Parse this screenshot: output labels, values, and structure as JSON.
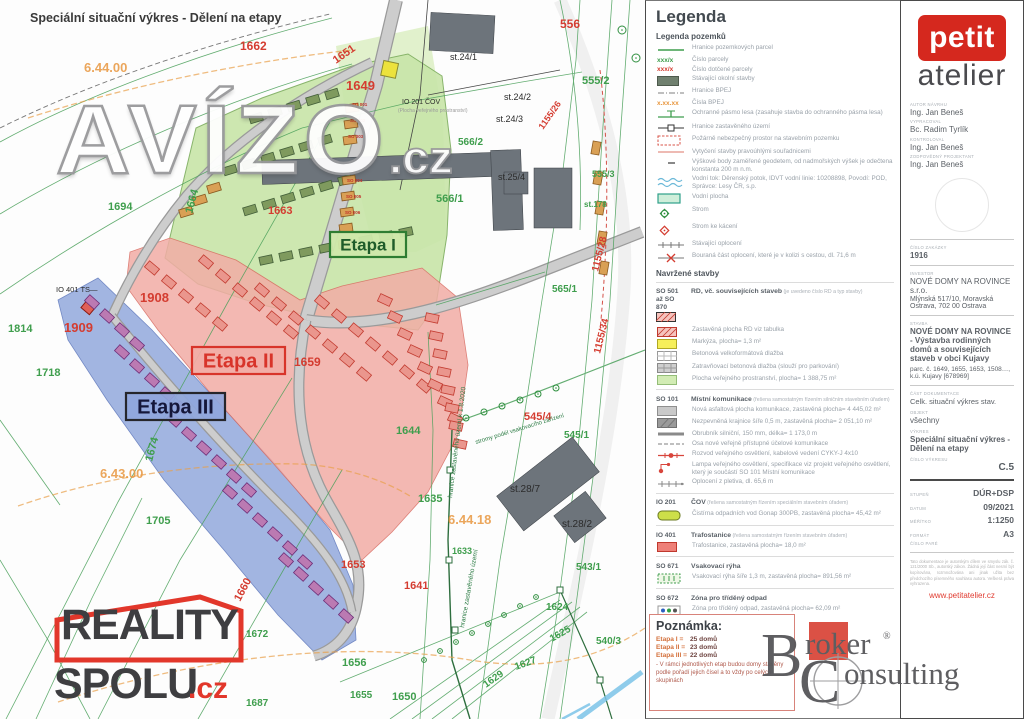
{
  "map": {
    "title": "Speciální situační výkres - Dělení na etapy",
    "etapas": [
      {
        "label": "Etapa I",
        "x": 330,
        "y": 232,
        "w": 76,
        "h": 25,
        "fill": "rgba(205,232,170,0.95)",
        "stroke": "#2e7d32",
        "color": "#1f5c2a",
        "size": 17
      },
      {
        "label": "Etapa II",
        "x": 192,
        "y": 347,
        "w": 93,
        "h": 27,
        "fill": "rgba(242,173,166,0.92)",
        "stroke": "#d8342a",
        "color": "#d8342a",
        "size": 20
      },
      {
        "label": "Etapa III",
        "x": 126,
        "y": 393,
        "w": 99,
        "h": 27,
        "fill": "rgba(143,166,220,0.92)",
        "stroke": "#26262b",
        "color": "#15173a",
        "size": 20
      }
    ],
    "labels": [
      [
        "Speciální situační výkres - Dělení na etapy",
        30,
        22,
        "t",
        12.5,
        0
      ],
      [
        "1694",
        108,
        210,
        "g",
        11,
        0
      ],
      [
        "1664",
        192,
        214,
        "g",
        11,
        -75
      ],
      [
        "1814",
        8,
        332,
        "g",
        11,
        0
      ],
      [
        "1718",
        36,
        376,
        "g",
        11,
        0
      ],
      [
        "1705",
        146,
        524,
        "g",
        11,
        0
      ],
      [
        "1644",
        396,
        434,
        "g",
        11,
        0
      ],
      [
        "1635",
        418,
        502,
        "g",
        11,
        0
      ],
      [
        "1633",
        452,
        554,
        "g",
        9,
        0
      ],
      [
        "1656",
        342,
        666,
        "g",
        11,
        0
      ],
      [
        "1655",
        350,
        698,
        "g",
        10,
        0
      ],
      [
        "1650",
        392,
        700,
        "g",
        11,
        0
      ],
      [
        "1672",
        246,
        637,
        "g",
        10,
        0
      ],
      [
        "1687",
        246,
        706,
        "g",
        10,
        0
      ],
      [
        "1629",
        486,
        688,
        "g",
        10,
        -35
      ],
      [
        "1627",
        516,
        670,
        "g",
        10,
        -20
      ],
      [
        "1624",
        546,
        610,
        "g",
        10,
        0
      ],
      [
        "1625",
        552,
        642,
        "g",
        10,
        -30
      ],
      [
        "565/1",
        552,
        292,
        "g",
        10,
        0
      ],
      [
        "566/1",
        436,
        202,
        "g",
        11,
        0
      ],
      [
        "566/2",
        458,
        145,
        "g",
        10,
        0
      ],
      [
        "555/2",
        582,
        84,
        "g",
        11,
        0
      ],
      [
        "555/3",
        592,
        177,
        "g",
        9,
        0
      ],
      [
        "545/1",
        564,
        438,
        "g",
        10,
        0
      ],
      [
        "543/1",
        576,
        570,
        "g",
        10,
        0
      ],
      [
        "540/3",
        596,
        644,
        "g",
        10,
        0
      ],
      [
        "st.178",
        584,
        207,
        "g",
        8,
        0
      ],
      [
        "1674",
        152,
        462,
        "g",
        11,
        -75
      ],
      [
        "1662",
        240,
        50,
        "r",
        12,
        0
      ],
      [
        "1649",
        346,
        90,
        "r",
        13,
        0
      ],
      [
        "1651",
        336,
        64,
        "r",
        11,
        -35
      ],
      [
        "1663",
        268,
        214,
        "r",
        11,
        0
      ],
      [
        "1908",
        140,
        302,
        "r",
        13,
        0
      ],
      [
        "1909",
        64,
        332,
        "r",
        13,
        0
      ],
      [
        "1659",
        294,
        366,
        "r",
        12,
        0
      ],
      [
        "556",
        560,
        28,
        "r",
        12,
        0
      ],
      [
        "545/4",
        524,
        420,
        "r",
        11,
        0
      ],
      [
        "1641",
        404,
        589,
        "r",
        11,
        0
      ],
      [
        "1653",
        341,
        568,
        "r",
        11,
        0
      ],
      [
        "1660",
        240,
        602,
        "r",
        11,
        -62
      ],
      [
        "1155/28",
        598,
        272,
        "r",
        10,
        -76
      ],
      [
        "1155/34",
        600,
        354,
        "r",
        10,
        -76
      ],
      [
        "1155/26",
        543,
        130,
        "r",
        9,
        -55
      ],
      [
        "6.44.00",
        84,
        72,
        "o",
        13,
        0
      ],
      [
        "6.43.00",
        100,
        478,
        "o",
        13,
        0
      ],
      [
        "6.44.18",
        448,
        524,
        "o",
        13,
        0
      ],
      [
        "st.24/1",
        450,
        60,
        "k",
        9,
        0
      ],
      [
        "st.24/2",
        504,
        100,
        "k",
        9,
        0
      ],
      [
        "st.24/3",
        496,
        122,
        "k",
        9,
        0
      ],
      [
        "st.25/4",
        498,
        180,
        "k",
        9,
        0
      ],
      [
        "st.28/7",
        510,
        492,
        "k",
        10,
        0
      ],
      [
        "st.28/2",
        562,
        527,
        "k",
        10,
        0
      ],
      [
        "IO 401 TS—",
        56,
        292,
        "k",
        7.5,
        0
      ],
      [
        "IO 201 ČOV",
        402,
        104,
        "k",
        7,
        0
      ],
      [
        "(Plocha veřejného prostranství)",
        398,
        112,
        "gy",
        5,
        0
      ],
      [
        "hranice zastavěného území k 1.8.2020",
        452,
        498,
        "dg",
        6.5,
        -83
      ],
      [
        "hranice zastavěného území",
        464,
        628,
        "dg",
        6.5,
        -80
      ],
      [
        "stromy podél vsakovacího zařízení",
        476,
        444,
        "dg",
        6,
        -17
      ],
      [
        "SO 001",
        352,
        106,
        "rs",
        4.5,
        0
      ],
      [
        "SO 002",
        350,
        122,
        "rs",
        4.5,
        0
      ],
      [
        "SO 003",
        348,
        138,
        "rs",
        4.5,
        0
      ],
      [
        "SO 004",
        347,
        182,
        "rs",
        4.5,
        0
      ],
      [
        "SO 005",
        346,
        198,
        "rs",
        4.5,
        0
      ],
      [
        "SO 006",
        345,
        214,
        "rs",
        4.5,
        0
      ]
    ]
  },
  "legend": {
    "title": "Legenda",
    "subtitle": "Legenda pozemků",
    "groups": [
      {
        "type": "plain",
        "rows": [
          {
            "sym": "line-green",
            "text": "Hranice pozemkových parcel"
          },
          {
            "sym": "num-green",
            "text": "Číslo parcely"
          },
          {
            "sym": "num-red",
            "text": "Číslo dotčené parcely"
          },
          {
            "sym": "rect-dkgreen",
            "text": "Stávající okolní stavby"
          },
          {
            "sym": "line-dashdot",
            "text": "Hranice BPEJ"
          },
          {
            "sym": "num-orange",
            "text": "Čísla BPEJ"
          },
          {
            "sym": "line-T",
            "text": "Ochranné pásmo lesa (zasahuje stavba do ochranného pásma lesa)"
          },
          {
            "sym": "line-sq",
            "text": "Hranice zastavěného území"
          },
          {
            "sym": "rect-reddash",
            "text": "Požárně nebezpečný prostor na stavebním pozemku"
          },
          {
            "sym": "line-pink",
            "text": "Vytyčení stavby pravoúhlými souřadnicemi"
          },
          {
            "sym": "tick",
            "text": "Výškové body zaměřené geodetem, od nadmořských výšek je odečtena konstanta 200 m n.m."
          },
          {
            "sym": "wavy",
            "text": "Vodní tok: Děrenský potok, IDVT vodní linie: 10208898, Povodí: POD, Správce: Lesy ČR, s.p."
          },
          {
            "sym": "rect-teal",
            "text": "Vodní plocha"
          },
          {
            "sym": "tree",
            "text": "Strom"
          },
          {
            "sym": "tree-red",
            "text": "Strom ke kácení"
          },
          {
            "sym": "fence",
            "text": "Stávající oplocení"
          },
          {
            "sym": "fence-x",
            "text": "Bouraná část oplocení, které je v kolizi s cestou, dl. 71,6 m"
          }
        ]
      },
      {
        "type": "heading",
        "text": "Navržené stavby"
      },
      {
        "type": "block",
        "code": "SO 501 až SO 870",
        "codeSym": "hatch-red-b",
        "title": "RD, vč. souvisejících staveb",
        "note": "(je uvedeno číslo RD a typ stavby)",
        "rows": [
          {
            "sym": "hatch-red",
            "text": "Zastavěná plocha RD viz tabulka"
          },
          {
            "sym": "rect-yellow",
            "text": "Markýza, plocha= 1,3 m²"
          },
          {
            "sym": "grid-white",
            "text": "Betonová velkoformátová dlažba"
          },
          {
            "sym": "grid-gray",
            "text": "Zatravňovací betonová dlažba (slouží pro parkování)"
          },
          {
            "sym": "rect-lgreen",
            "text": "Plocha veřejného prostranství, plocha= 1 388,75 m²"
          }
        ]
      },
      {
        "type": "block",
        "code": "SO 101",
        "title": "Místní komunikace",
        "note": "(řešena samostatným řízením silničním stavebním úřadem)",
        "rows": [
          {
            "sym": "rect-gray",
            "text": "Nová asfaltová plocha komunikace, zastavěná plocha= 4 445,02 m²"
          },
          {
            "sym": "rect-dgray",
            "text": "Nezpevněná krajnice šíře 0,5 m, zastavěná plocha= 2 051,10 m²"
          },
          {
            "sym": "line-thick",
            "text": "Obrubník silniční, 150 mm, délka= 1 173,0 m"
          },
          {
            "sym": "line-dash",
            "text": "Osa nové veřejně přístupné účelové komunikace"
          },
          {
            "sym": "line-reddot",
            "text": "Rozvod veřejného osvětlení, kabelové vedení CYKY-J 4x10"
          },
          {
            "sym": "lamp",
            "text": "Lampa veřejného osvětlení, specifikace viz projekt veřejného osvětlení, který je součástí SO 101 Místní komunikace"
          },
          {
            "sym": "fence2",
            "text": "Oplocení z pletiva, dl. 65,6 m"
          }
        ]
      },
      {
        "type": "block",
        "code": "IO 201",
        "title": "ČOV",
        "note": "(řešena samostatným řízením speciálním stavebním úřadem)",
        "rows": [
          {
            "sym": "pill-yg",
            "text": "Čistírna odpadních vod Gonap 300PB, zastavěná plocha= 45,42 m²"
          }
        ]
      },
      {
        "type": "block",
        "code": "IO 401",
        "title": "Trafostanice",
        "note": "(řešena samostatným řízením stavebním úřadem)",
        "rows": [
          {
            "sym": "rect-redsolid",
            "text": "Trafostanice, zastavěná plocha= 18,0 m²"
          }
        ]
      },
      {
        "type": "block",
        "code": "SO 671",
        "title": "Vsakovací rýha",
        "note": "",
        "rows": [
          {
            "sym": "rect-gdash",
            "text": "Vsakovací rýha šíře 1,3 m, zastavěná plocha= 891,56 m²"
          }
        ]
      },
      {
        "type": "block",
        "code": "SO 672",
        "title": "Zóna pro tříděný odpad",
        "note": "",
        "rows": [
          {
            "sym": "zona",
            "text": "Zóna pro tříděný odpad, zastavěná plocha= 62,09 m²"
          }
        ]
      }
    ]
  },
  "poznamka": {
    "title": "Poznámka:",
    "rows": [
      {
        "label": "Etapa I =",
        "value": "25 domů"
      },
      {
        "label": "Etapa II =",
        "value": "23 domů"
      },
      {
        "label": "Etapa III =",
        "value": "22 domů"
      }
    ],
    "note": "- V rámci jednotlivých etap budou domy stavěny podle pořadí jejich čísel a to vždy po celých skupinách"
  },
  "sidebar": {
    "logo_top": "petit",
    "logo_bottom": "atelier",
    "people": [
      {
        "label": "AUTOR NÁVRHU",
        "name": "Ing. Jan Beneš"
      },
      {
        "label": "VYPRACOVAL",
        "name": "Bc. Radim Tyrlík"
      },
      {
        "label": "KONTROLOVAL",
        "name": "Ing. Jan Beneš"
      },
      {
        "label": "ZODPOVĚDNÝ PROJEKTANT",
        "name": "Ing. Jan Beneš"
      }
    ],
    "zakazka_label": "ČÍSLO ZAKÁZKY",
    "zakazka": "1916",
    "investor_label": "INVESTOR",
    "investor_name": "NOVÉ DOMY NA ROVINCE s.r.o.",
    "investor_addr": "Mlýnská 517/10, Moravská Ostrava, 702 00 Ostrava",
    "stavba_label": "STAVBA",
    "stavba": "NOVÉ DOMY NA ROVINCE - Výstavba rodinných domů a souvisejících staveb v obci Kujavy",
    "parcely": "parc. č. 1649, 1655, 1653, 1508…, k.ú. Kujavy [678969]",
    "cast_label": "ČÁST DOKUMENTACE",
    "cast": "Celk. situační výkres stav.",
    "objekt_label": "OBJEKT",
    "objekt": "všechny",
    "vykres_label": "VÝKRES",
    "vykres": "Speciální situační výkres - Dělení na etapy",
    "cislo_vykresu_label": "ČÍSLO VÝKRESU",
    "cislo_vykresu": "C.5",
    "meta": [
      {
        "label": "STUPEŇ",
        "value": "DÚR+DSP"
      },
      {
        "label": "DATUM",
        "value": "09/2021"
      },
      {
        "label": "MĚŘÍTKO",
        "value": "1:1250"
      },
      {
        "label": "FORMÁT",
        "value": "A3"
      },
      {
        "label": "ČÍSLO PARÉ",
        "value": ""
      }
    ],
    "copyright": "Tato dokumentace je autorským dílem ve smyslu zák. č. 121/2000 Sb., autorský zákon. Žádná její část nesmí být kopírována, rozmnožována ani jinak užita bez předchozího písemného souhlasu autora. Veškerá práva vyhrazena.",
    "web": "www.petitatelier.cz"
  },
  "watermarks": {
    "avizo": "AVÍZO",
    "avizo_cz": ".cz",
    "reality_line1": "REALITY",
    "reality_line2": "SPOLU",
    "reality_cz": ".cz",
    "broker_B": "B",
    "broker_roker": "roker",
    "broker_reg": "®",
    "broker_C": "C",
    "broker_onsulting": "onsulting"
  },
  "colors": {
    "etapa1_fill": "#c9e6aa",
    "etapa2_fill": "#f2ada6",
    "etapa3_fill": "#8fa6dc",
    "parcel_green": "#3f9e4d",
    "parcel_red": "#d43c30",
    "bpej_orange": "#e8973f",
    "petit_red": "#d5281e",
    "broker_red": "#da4a3e",
    "reality_red": "#e2372b"
  }
}
